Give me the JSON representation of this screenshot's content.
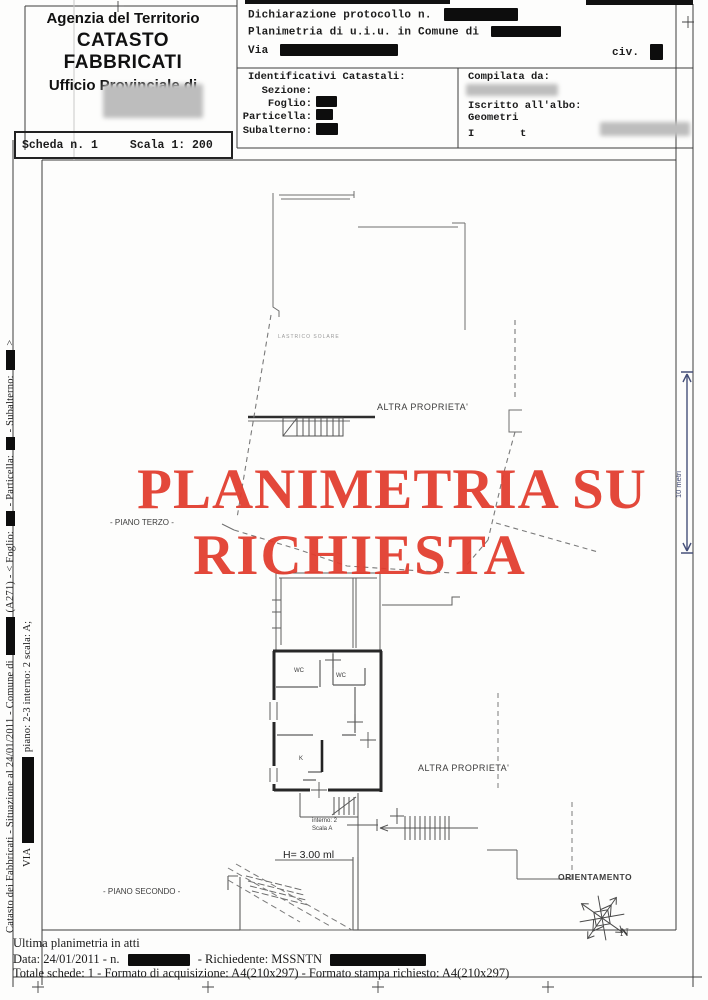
{
  "colors": {
    "watermark_red": "#e23b2c",
    "scale_bar_blue": "#46507a",
    "redaction_black": "#0d0d0d"
  },
  "header": {
    "agency": {
      "line1": "Agenzia del Territorio",
      "line2": "CATASTO FABBRICATI",
      "line3": "Ufficio Provinciale di"
    },
    "scheda": {
      "number": "Scheda n. 1",
      "scale": "Scala 1: 200"
    },
    "declaration": {
      "protocol": "Dichiarazione protocollo n.",
      "planimetria": "Planimetria di u.i.u. in Comune di",
      "via": "Via",
      "civ": "civ."
    },
    "identificativi": {
      "title": "Identificativi Catastali:",
      "sezione": "Sezione:",
      "foglio": "Foglio:",
      "particella": "Particella:",
      "subalterno": "Subalterno:"
    },
    "compilata": {
      "title": "Compilata da:",
      "albo": "Iscritto all'albo:",
      "albo_value": "Geometri",
      "fragment_left": "I",
      "fragment_right": "t"
    }
  },
  "sidebar": {
    "line1_a": "Catasto dei Fabbricati - Situazione al 24/01/2011 - Comune di",
    "line1_b": "(A271) - < Foglio:",
    "line1_c": "- Particella:",
    "line1_d": "- Subalterno:",
    "line1_e": ">",
    "line2_a": "VIA",
    "line2_b": "piano: 2-3 interno: 2 scala: A;"
  },
  "watermark": {
    "line1": "PLANIMETRIA SU",
    "line2": "RICHIESTA"
  },
  "plan": {
    "lastrico_solare": "LASTRICO SOLARE",
    "altra_proprieta_top": "ALTRA PROPRIETA'",
    "altra_proprieta_bottom": "ALTRA PROPRIETA'",
    "piano_terzo": "- PIANO TERZO -",
    "piano_secondo": "- PIANO SECONDO -",
    "room_wc_1": "WC",
    "room_wc_2": "WC",
    "room_k": "K",
    "interno": "interno: 2",
    "scala": "Scala A",
    "altezza": "H= 3.00 ml",
    "scale_bar": "10 metri",
    "orientamento": "ORIENTAMENTO",
    "north": "N"
  },
  "footer": {
    "line1": "Ultima planimetria in atti",
    "line2_a": "Data: 24/01/2011 - n.",
    "line2_b": "- Richiedente: MSSNTN",
    "line3": "Totale schede: 1 - Formato di acquisizione: A4(210x297) - Formato stampa richiesto: A4(210x297)"
  }
}
